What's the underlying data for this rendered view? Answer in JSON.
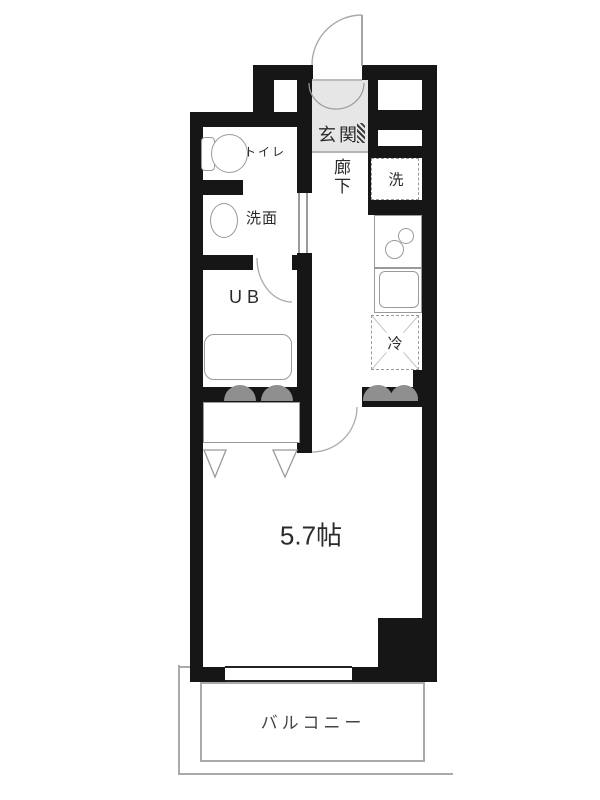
{
  "floorplan": {
    "type": "apartment-floor-plan",
    "labels": {
      "genkan": "玄関",
      "hallway": "廊下",
      "toilet": "トイレ",
      "washroom": "洗面",
      "unit_bath": "UB",
      "washer": "洗",
      "refrigerator": "冷",
      "main_room": "5.7帖",
      "balcony": "バルコニー"
    },
    "main_room_area_tatami": 5.7,
    "colors": {
      "wall": "#161616",
      "fixture_line": "#9a9a9a",
      "label_text": "#2b2b2b",
      "genkan_floor": "#e6e6e6",
      "door_bump": "#8f8f8f",
      "balcony_line": "#aaaaaa"
    }
  }
}
